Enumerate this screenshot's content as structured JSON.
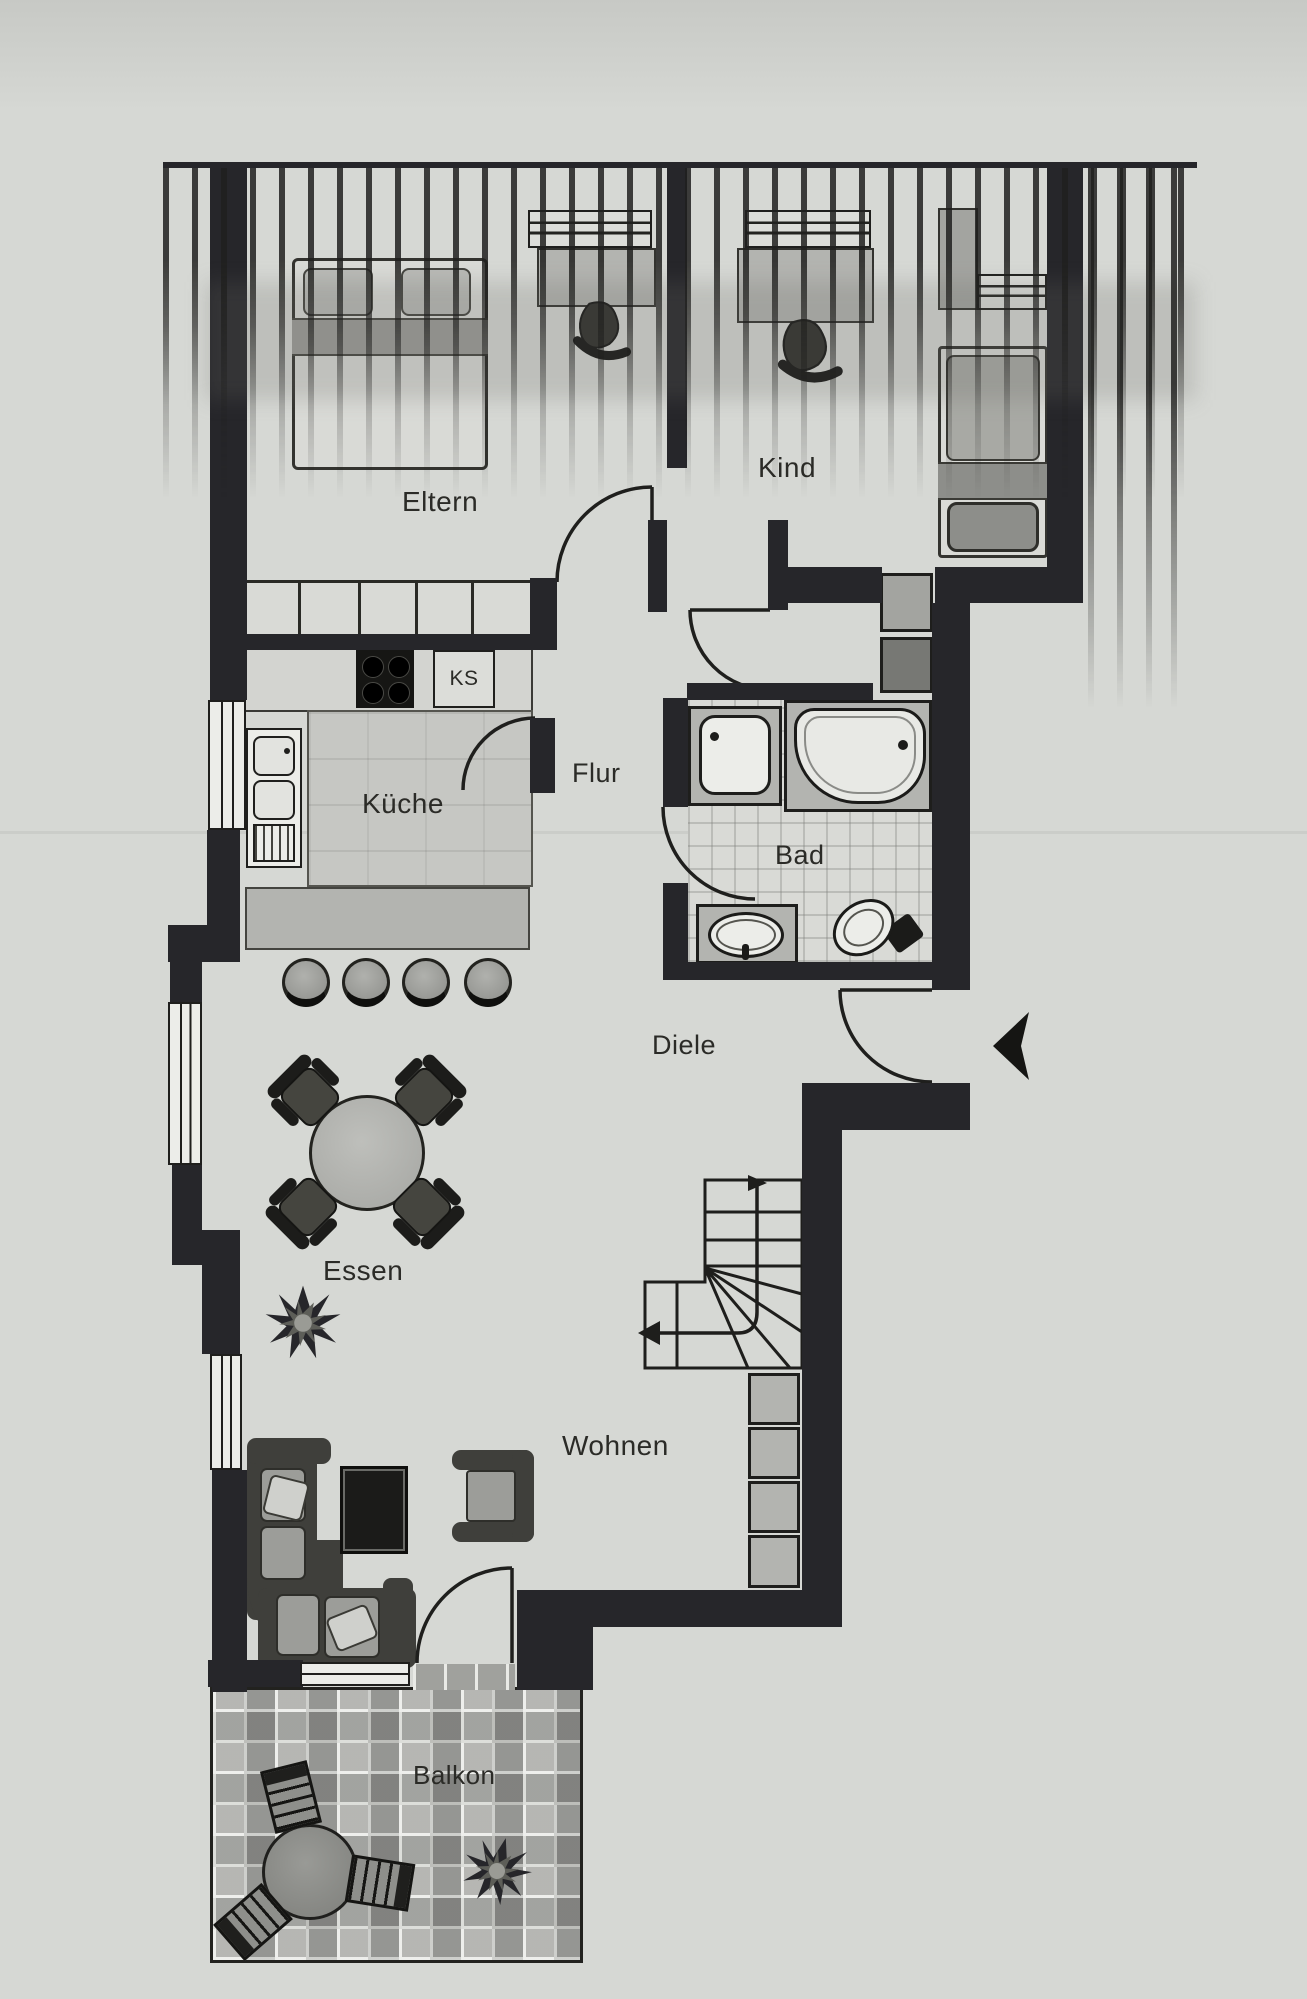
{
  "rooms": {
    "eltern": "Eltern",
    "kind": "Kind",
    "kueche": "Küche",
    "flur": "Flur",
    "bad": "Bad",
    "diele": "Diele",
    "essen": "Essen",
    "wohnen": "Wohnen",
    "balkon": "Balkon"
  },
  "appliances": {
    "ks": "KS"
  },
  "symbols": {
    "entrance_arrow": "left-pointing-entrance-arrow",
    "stair_direction": "stair-walk-line-arrows"
  },
  "colors": {
    "paper": "#d6d8d4",
    "wall": "#26262a",
    "furniture_gray": "#b3b4b0",
    "tile_gray": "#a0a19d",
    "line_dark": "#1e1e1c"
  }
}
